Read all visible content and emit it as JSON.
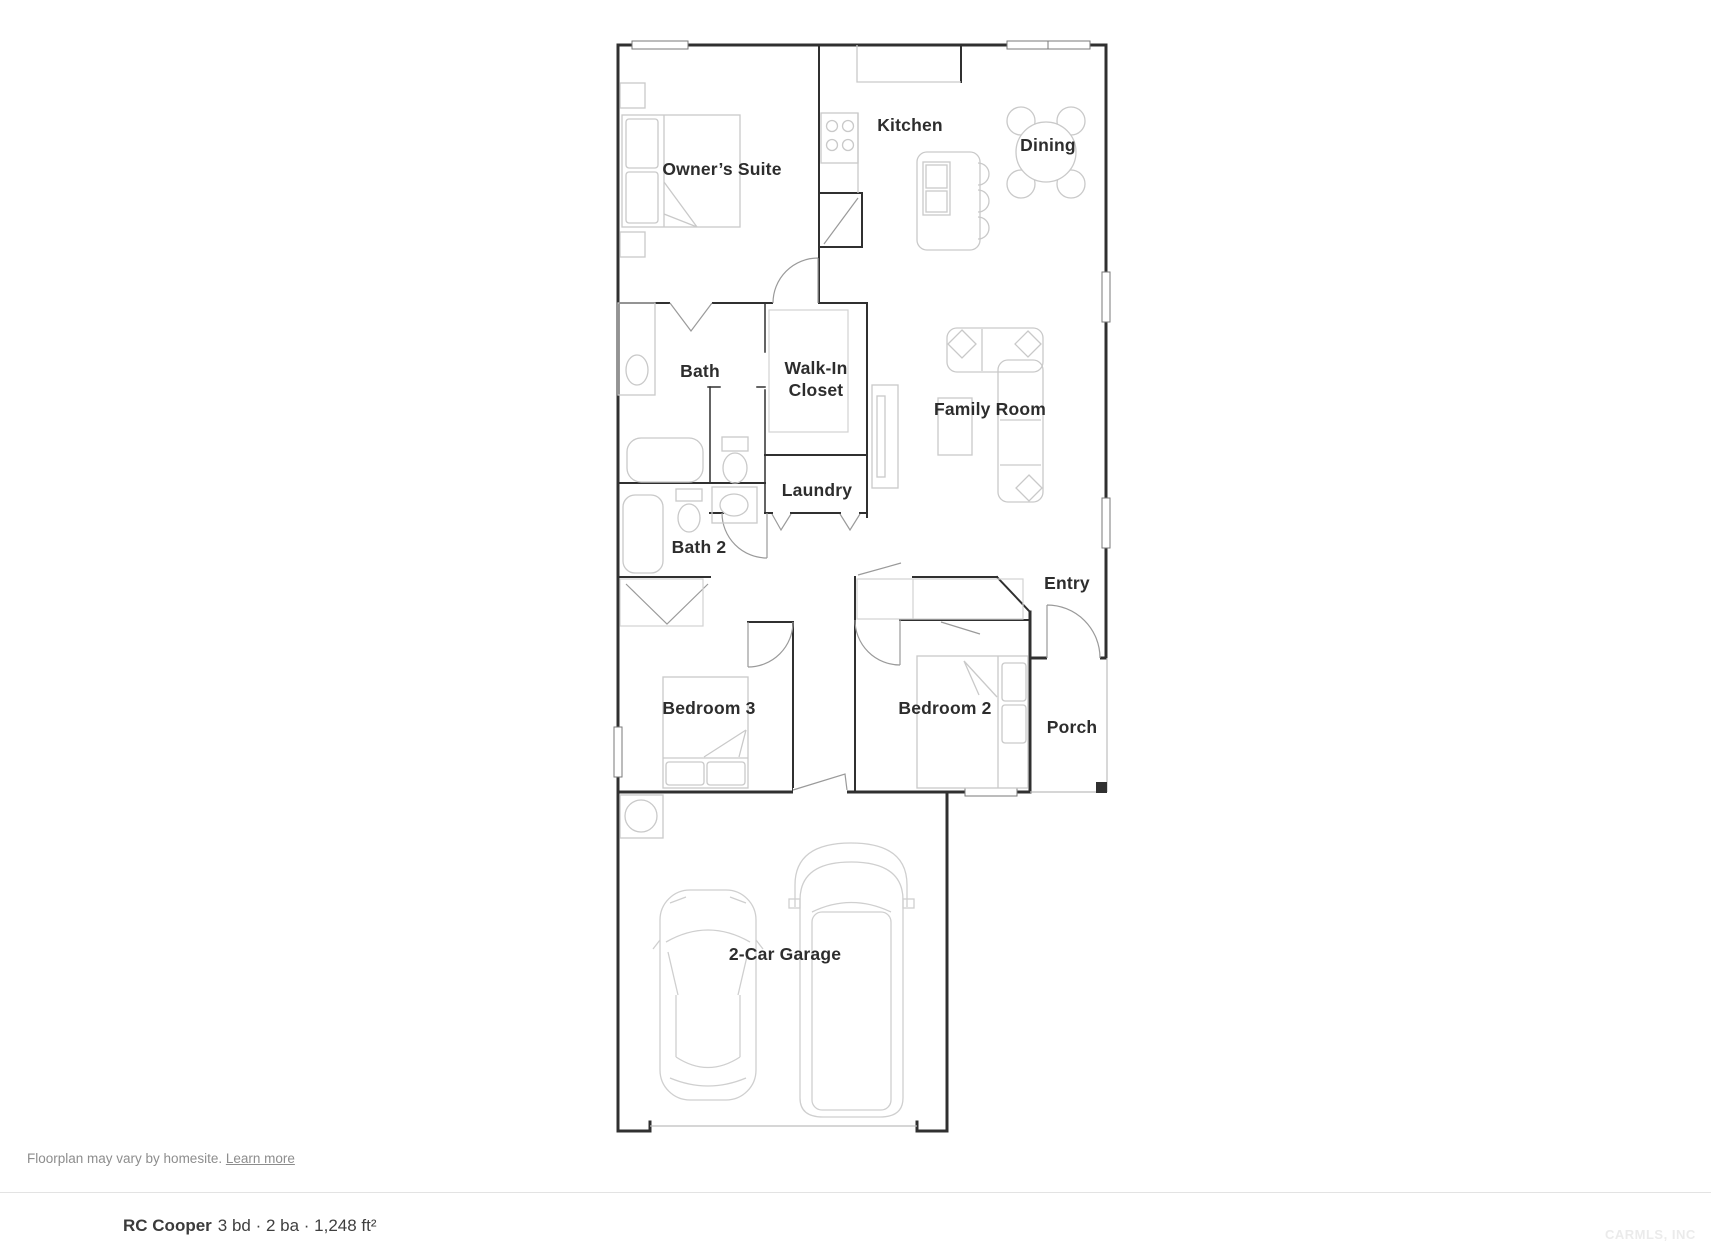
{
  "rooms": {
    "owners_suite": "Owner’s Suite",
    "kitchen": "Kitchen",
    "dining": "Dining",
    "bath": "Bath",
    "walk_in_closet": "Walk-In Closet",
    "family_room": "Family Room",
    "laundry": "Laundry",
    "bath_2": "Bath 2",
    "entry": "Entry",
    "bedroom_3": "Bedroom 3",
    "bedroom_2": "Bedroom 2",
    "porch": "Porch",
    "garage": "2-Car Garage"
  },
  "footer": {
    "disclaimer": "Floorplan may vary by homesite.",
    "learn_more": "Learn more"
  },
  "summary": {
    "plan_name": "RC Cooper",
    "stats": "3 bd · 2 ba · 1,248 ft²"
  },
  "watermark": "CARMLS, INC",
  "colors": {
    "wall": "#303030",
    "furniture": "#c9c9c9",
    "door": "#9a9a9a"
  }
}
